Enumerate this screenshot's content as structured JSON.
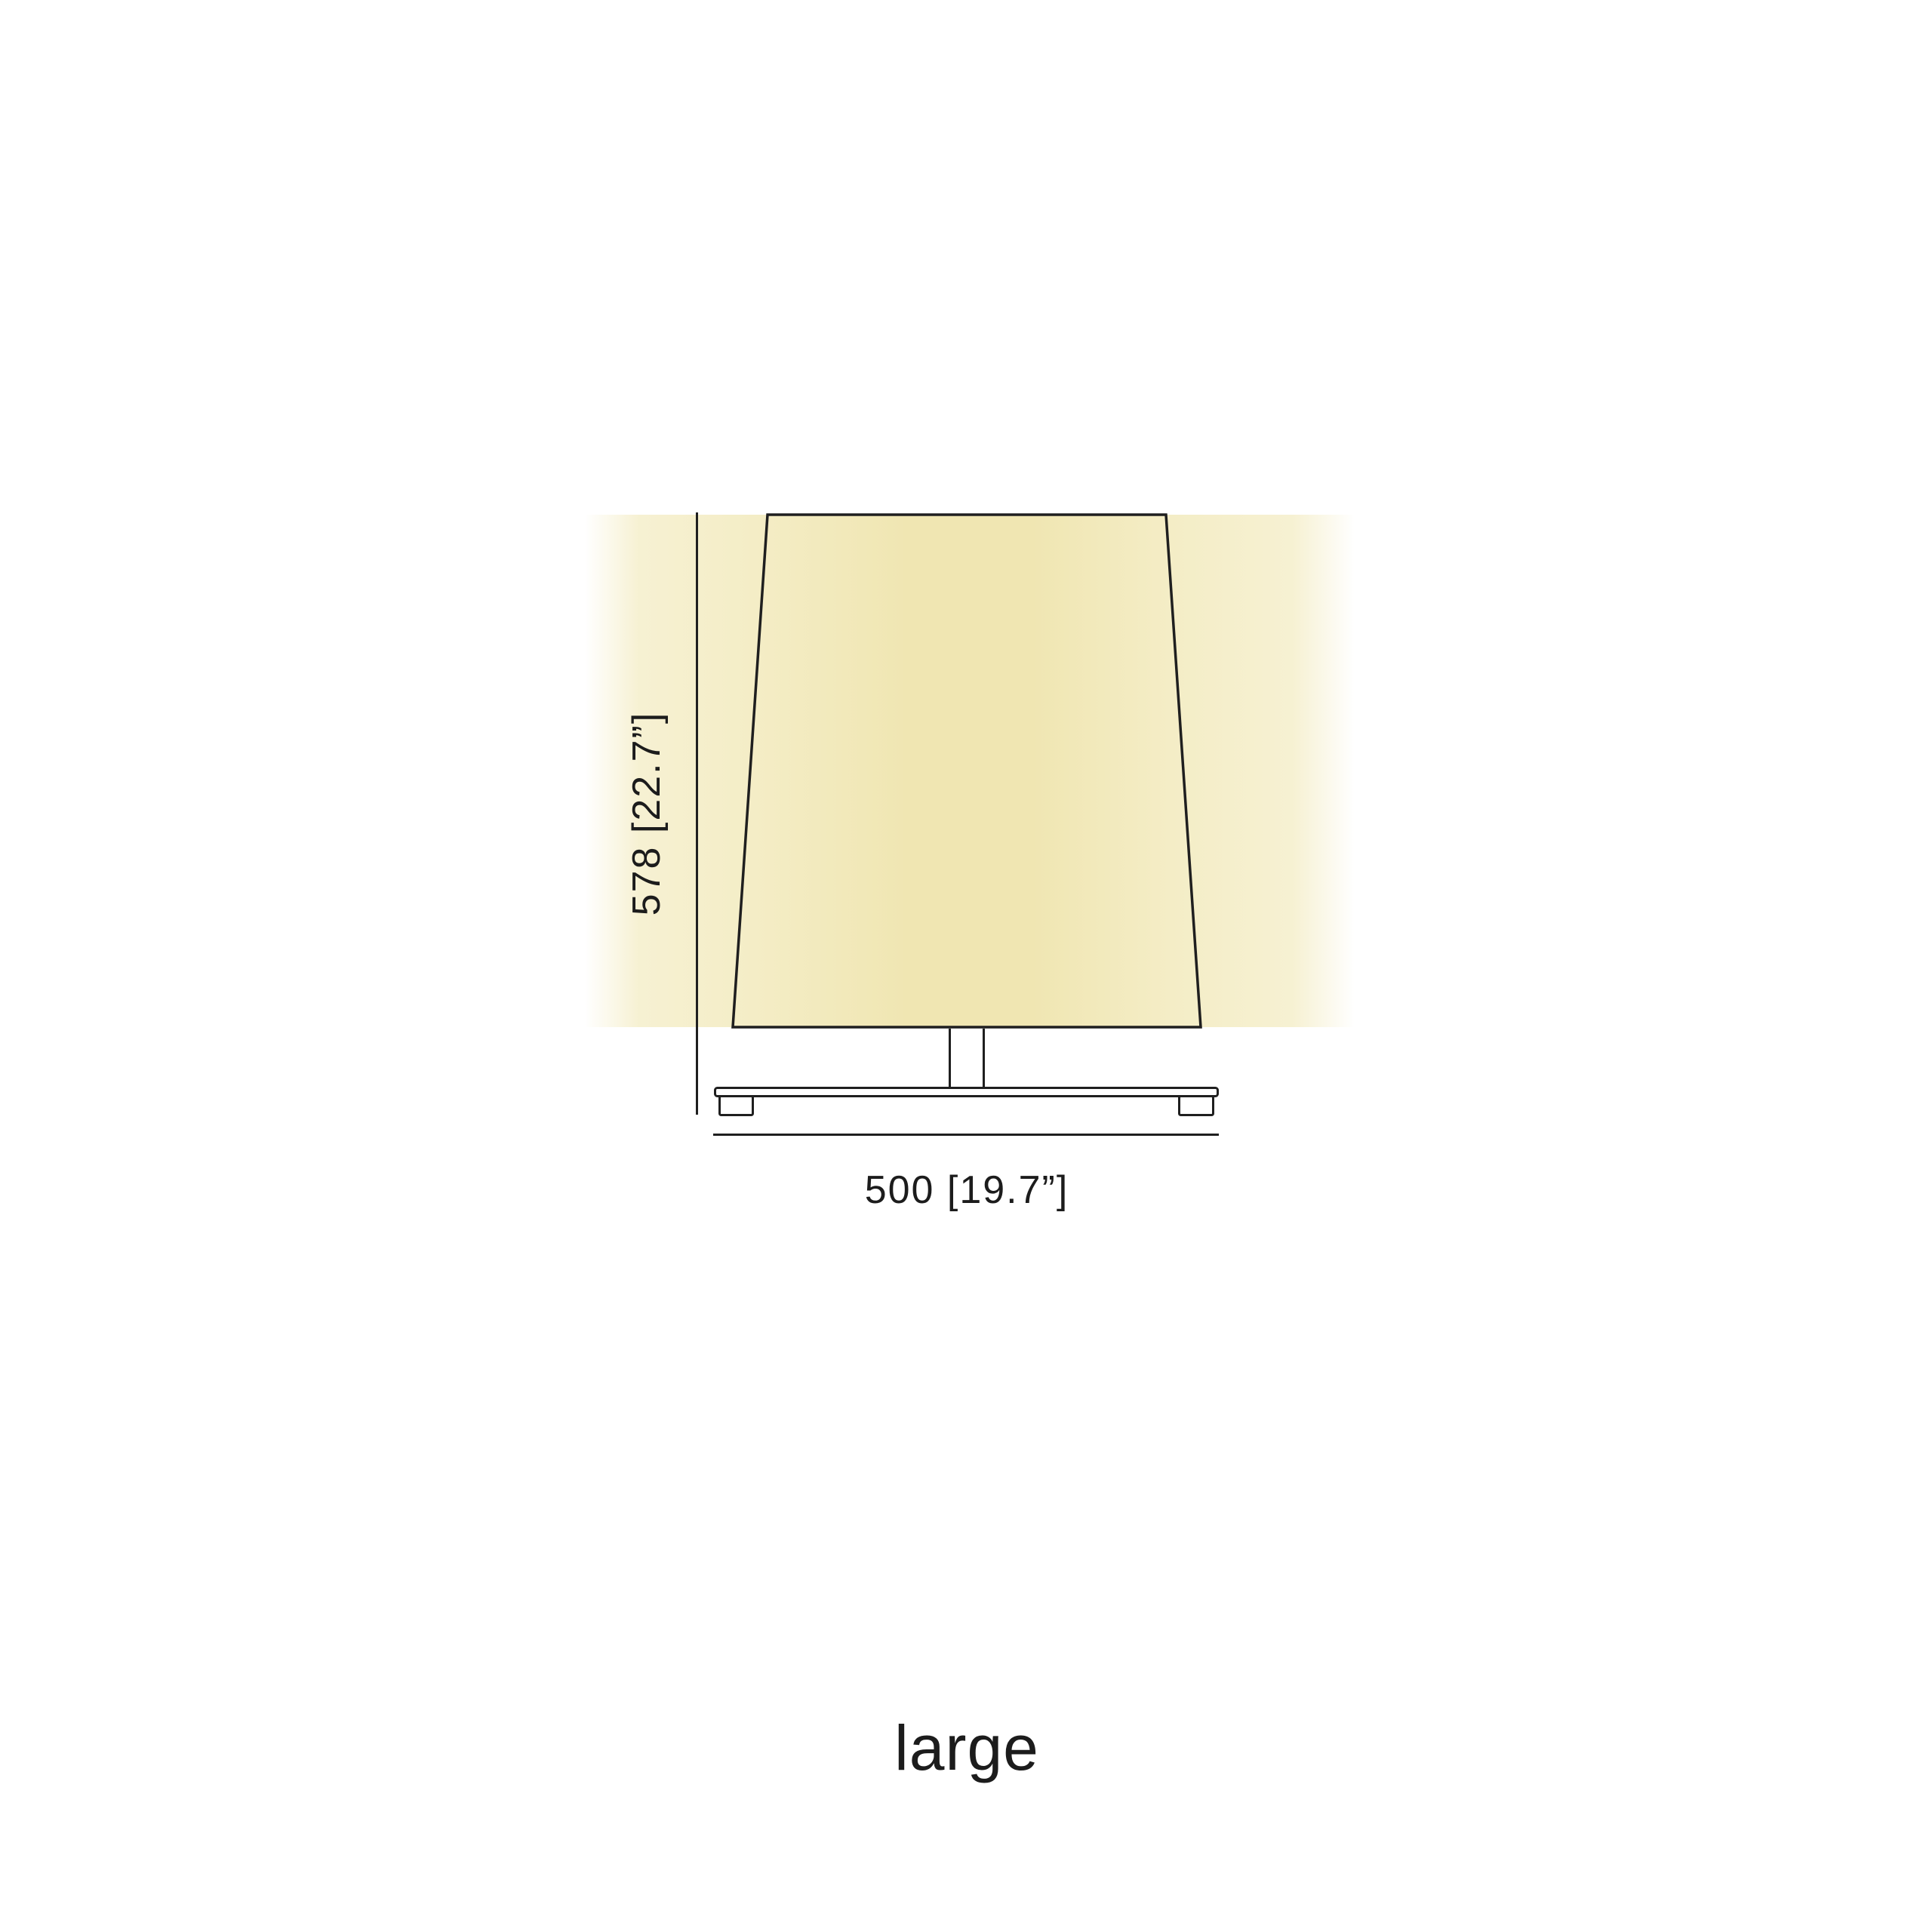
{
  "diagram": {
    "height_label": "578 [22.7”]",
    "width_label": "500 [19.7”]",
    "size_label": "large"
  },
  "colors": {
    "background": "#ffffff",
    "line": "#1f1f1f",
    "text": "#1c1c1c",
    "glow_core": "#f0e6b2",
    "glow_mid": "#f4edc6",
    "shade_light": "#f9f4da",
    "shade_deep": "#f1e7b4",
    "shade_mid": "#f6efca",
    "shade_deep2": "#f3eabe"
  }
}
